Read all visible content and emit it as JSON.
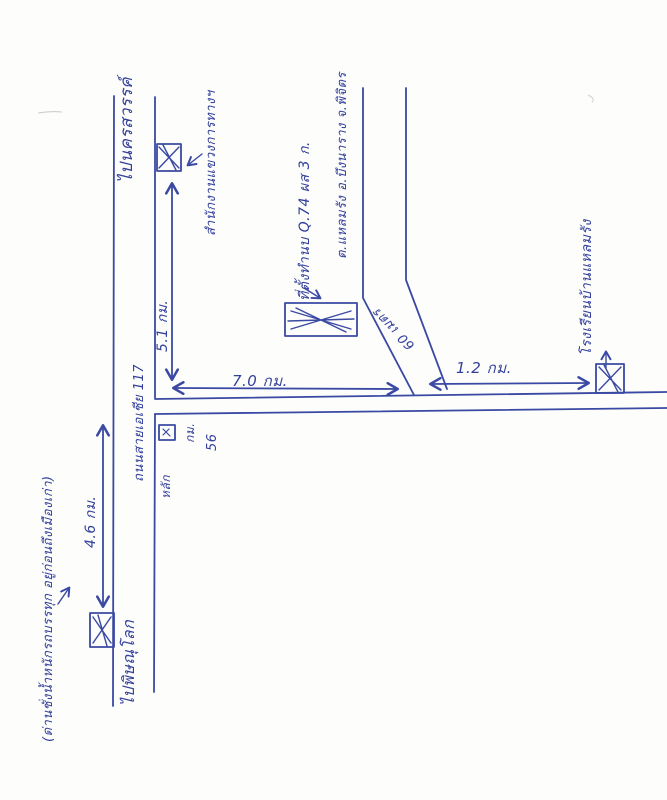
{
  "map": {
    "ink_color": "#3a49a3",
    "paper_color": "#fdfdfb",
    "main_road": {
      "name": "ถนนสายเอเชีย 117",
      "north_destination": "ไปนครสวรรค์",
      "south_destination": "ไปพิษณุโลก"
    },
    "access_road": {
      "length": "60 เมตร"
    },
    "distances": {
      "office_to_junction": "5.1 กม.",
      "junction_to_access_road": "7.0 กม.",
      "access_road_to_school": "1.2 กม.",
      "junction_to_weigh_station": "4.6 กม."
    },
    "landmarks": {
      "highway_office": "สำนักงานแขวงการทางฯ",
      "project_site_line1": "ที่ตั้งทำนบ Q.74 ผส 3 ก.",
      "project_site_line2": "ต.แหลมรัง อ.บึงนาราง จ.พิจิตร",
      "school": "โรงเรียนบ้านแหลมรัง",
      "km_post_prefix": "หลัก",
      "km_post_unit": "กม.",
      "km_post_number": "56",
      "roadside_note": "(ด่านชั่งน้ำหนักรถบรรทุก อยู่ก่อนถึงเมืองเก่า)"
    }
  }
}
